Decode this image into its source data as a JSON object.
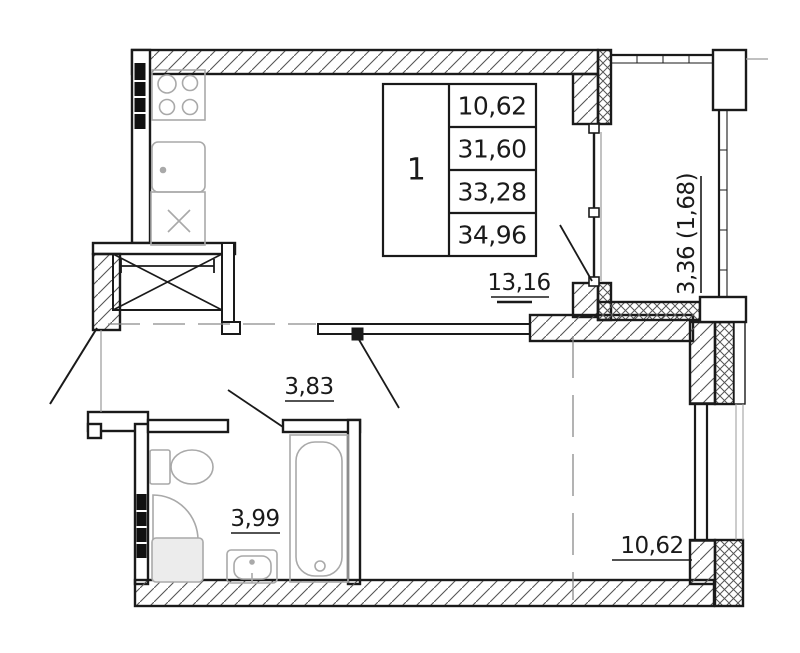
{
  "info_table": {
    "unit_number": "1",
    "rows": [
      "10,62",
      "31,60",
      "33,28",
      "34,96"
    ]
  },
  "labels": {
    "kitchen_living": "13,16",
    "hall": "3,83",
    "bathroom": "3,99",
    "room": "10,62",
    "balcony": "3,36 (1,68)"
  },
  "colors": {
    "wall": "#1a1a1a",
    "fixture": "#a9a9a9",
    "hatch": "#555555",
    "dash_line": "#8a8a8a",
    "background": "#ffffff"
  }
}
